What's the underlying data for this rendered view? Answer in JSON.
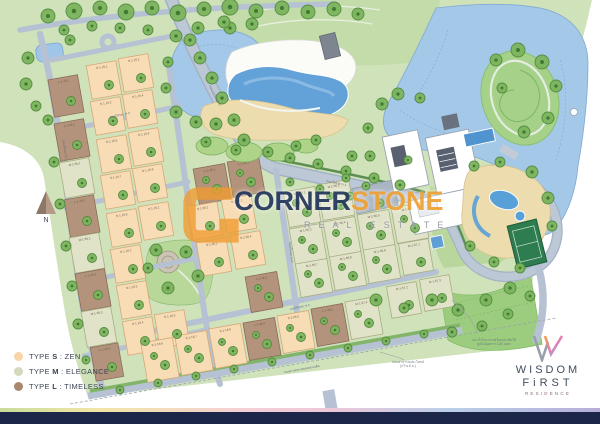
{
  "watermark": {
    "part1": "CORNER",
    "part2": "STONE",
    "tagline": "REAL ESTATE",
    "navy": "#24375c",
    "orange": "#f0a236"
  },
  "compass": {
    "label": "N"
  },
  "legend": {
    "items": [
      {
        "prefix": "TYPE",
        "letter": "S",
        "sep": ":",
        "name": "ZEN",
        "color": "#f9d4a8"
      },
      {
        "prefix": "TYPE",
        "letter": "M",
        "sep": ":",
        "name": "ELEGANCE",
        "color": "#d4d8bd"
      },
      {
        "prefix": "TYPE",
        "letter": "L",
        "sep": ":",
        "name": "TIMELESS",
        "color": "#a9886e"
      }
    ]
  },
  "brand": {
    "line1": "WISDOM",
    "line2": "FiRST",
    "line3": "RESIDENCE"
  },
  "map": {
    "colors": {
      "S": "#f8dcb6",
      "Sb": "#d4a876",
      "M": "#e1e3c9",
      "Mb": "#a9ad85",
      "L": "#b3937b",
      "Lb": "#8a6e58"
    },
    "plots": [
      [
        "L",
        66,
        96,
        30,
        38,
        -10,
        "L-1-45.1"
      ],
      [
        "L",
        72,
        140,
        30,
        38,
        -10,
        "L-1-45.2"
      ],
      [
        "M",
        77,
        178,
        30,
        36,
        -10,
        "M-1-55.1"
      ],
      [
        "L",
        82,
        216,
        30,
        38,
        -10,
        "L-1-45.3"
      ],
      [
        "M",
        87,
        253,
        30,
        36,
        -10,
        "M-1-55.2"
      ],
      [
        "L",
        93,
        290,
        30,
        38,
        -10,
        "L-1-45.4"
      ],
      [
        "M",
        99,
        327,
        30,
        36,
        -10,
        "M-1-55.3"
      ],
      [
        "L",
        107,
        362,
        28,
        34,
        -10,
        "L-1-45.5"
      ],
      [
        "S",
        104,
        80,
        30,
        34,
        -10,
        "S-1-15.1"
      ],
      [
        "S",
        136,
        73,
        30,
        34,
        -10,
        "S-1-15.2"
      ],
      [
        "S",
        108,
        116,
        30,
        34,
        -10,
        "S-1-15.3"
      ],
      [
        "S",
        140,
        109,
        30,
        34,
        -10,
        "S-1-15.4"
      ],
      [
        "S",
        114,
        154,
        30,
        34,
        -10,
        "S-1-15.5"
      ],
      [
        "S",
        146,
        147,
        30,
        34,
        -10,
        "S-1-15.6"
      ],
      [
        "S",
        118,
        190,
        30,
        34,
        -10,
        "S-1-15.7"
      ],
      [
        "S",
        150,
        183,
        30,
        34,
        -10,
        "S-1-15.8"
      ],
      [
        "S",
        124,
        228,
        30,
        34,
        -10,
        "S-1-15.9"
      ],
      [
        "S",
        156,
        221,
        30,
        34,
        -10,
        "S-1-16.1"
      ],
      [
        "S",
        128,
        264,
        30,
        34,
        -10,
        "S-1-16.2"
      ],
      [
        "S",
        134,
        300,
        30,
        34,
        -10,
        "S-1-16.3"
      ],
      [
        "S",
        140,
        336,
        30,
        34,
        -10,
        "S-1-16.4"
      ],
      [
        "S",
        172,
        329,
        30,
        34,
        -10,
        "S-1-16.5"
      ],
      [
        "L",
        212,
        184,
        32,
        36,
        -10,
        "L-1-46.1"
      ],
      [
        "L",
        246,
        177,
        32,
        36,
        -10,
        "L-1-46.2"
      ],
      [
        "S",
        205,
        221,
        30,
        34,
        -10,
        "S-1-55.1"
      ],
      [
        "S",
        239,
        214,
        30,
        34,
        -10,
        "S-1-55.2"
      ],
      [
        "S",
        214,
        257,
        30,
        34,
        -10,
        "S-1-55.3"
      ],
      [
        "S",
        248,
        250,
        30,
        34,
        -10,
        "S-1-55.4"
      ],
      [
        "M",
        302,
        207,
        32,
        36,
        -10,
        "M-1-56.1"
      ],
      [
        "M",
        336,
        200,
        32,
        36,
        -10,
        "M-1-56.2"
      ],
      [
        "M",
        308,
        244,
        32,
        36,
        -10,
        "M-1-56.3"
      ],
      [
        "M",
        342,
        237,
        32,
        36,
        -10,
        "M-1-56.4"
      ],
      [
        "M",
        376,
        230,
        32,
        36,
        -10,
        "M-1-56.5"
      ],
      [
        "M",
        410,
        223,
        32,
        36,
        -10,
        "M-1-56.6"
      ],
      [
        "M",
        314,
        278,
        32,
        34,
        -10,
        "M-1-56.7"
      ],
      [
        "M",
        348,
        271,
        32,
        34,
        -10,
        "M-1-56.8"
      ],
      [
        "M",
        382,
        264,
        32,
        34,
        -10,
        "M-1-56.9"
      ],
      [
        "M",
        416,
        257,
        30,
        32,
        -10,
        "M-1-57.1"
      ],
      [
        "L",
        264,
        292,
        32,
        36,
        -10,
        "L-1-46.3"
      ],
      [
        "M",
        404,
        300,
        30,
        32,
        -10,
        "M-1-57.2"
      ],
      [
        "M",
        437,
        293,
        30,
        32,
        -10,
        "M-1-57.3"
      ],
      [
        "S",
        160,
        360,
        32,
        40,
        -10,
        "S-1-16.6"
      ],
      [
        "S",
        194,
        353,
        32,
        40,
        -10,
        "S-1-16.7"
      ],
      [
        "S",
        228,
        346,
        32,
        40,
        -10,
        "S-1-16.8"
      ],
      [
        "L",
        262,
        339,
        32,
        38,
        -10,
        "L-1-46.4"
      ],
      [
        "S",
        296,
        332,
        32,
        38,
        -10,
        "S-1-55.5"
      ],
      [
        "L",
        330,
        325,
        32,
        38,
        -10,
        "L-1-46.5"
      ],
      [
        "M",
        364,
        318,
        32,
        38,
        -10,
        "M-1-57.4"
      ]
    ],
    "trees": [
      [
        48,
        16,
        7
      ],
      [
        74,
        11,
        8
      ],
      [
        100,
        8,
        7
      ],
      [
        126,
        12,
        8
      ],
      [
        152,
        8,
        7
      ],
      [
        178,
        13,
        8
      ],
      [
        204,
        9,
        7
      ],
      [
        230,
        7,
        8
      ],
      [
        256,
        11,
        7
      ],
      [
        282,
        8,
        7
      ],
      [
        308,
        12,
        7
      ],
      [
        334,
        9,
        7
      ],
      [
        358,
        14,
        6
      ],
      [
        64,
        30,
        5
      ],
      [
        92,
        26,
        5
      ],
      [
        120,
        28,
        5
      ],
      [
        148,
        30,
        5
      ],
      [
        230,
        28,
        6
      ],
      [
        252,
        24,
        6
      ],
      [
        190,
        40,
        6
      ],
      [
        200,
        58,
        6
      ],
      [
        212,
        78,
        6
      ],
      [
        222,
        98,
        6
      ],
      [
        234,
        120,
        6
      ],
      [
        244,
        140,
        6
      ],
      [
        176,
        36,
        6
      ],
      [
        198,
        28,
        6
      ],
      [
        224,
        22,
        6
      ],
      [
        168,
        62,
        5
      ],
      [
        166,
        88,
        5
      ],
      [
        176,
        112,
        6
      ],
      [
        196,
        122,
        6
      ],
      [
        216,
        124,
        6
      ],
      [
        48,
        120,
        5
      ],
      [
        54,
        162,
        5
      ],
      [
        60,
        204,
        5
      ],
      [
        66,
        246,
        5
      ],
      [
        72,
        286,
        5
      ],
      [
        78,
        324,
        5
      ],
      [
        86,
        360,
        4
      ],
      [
        28,
        58,
        6
      ],
      [
        26,
        84,
        6
      ],
      [
        36,
        106,
        5
      ],
      [
        70,
        40,
        5
      ],
      [
        206,
        142,
        5
      ],
      [
        236,
        150,
        5
      ],
      [
        268,
        152,
        5
      ],
      [
        296,
        146,
        5
      ],
      [
        316,
        140,
        5
      ],
      [
        290,
        158,
        5
      ],
      [
        318,
        164,
        5
      ],
      [
        346,
        171,
        5
      ],
      [
        374,
        178,
        5
      ],
      [
        400,
        185,
        5
      ],
      [
        290,
        182,
        4
      ],
      [
        320,
        189,
        4
      ],
      [
        350,
        196,
        4
      ],
      [
        380,
        203,
        4
      ],
      [
        382,
        104,
        6
      ],
      [
        398,
        94,
        6
      ],
      [
        420,
        98,
        5
      ],
      [
        368,
        128,
        5
      ],
      [
        370,
        156,
        5
      ],
      [
        366,
        186,
        4
      ],
      [
        496,
        60,
        6
      ],
      [
        518,
        50,
        7
      ],
      [
        542,
        62,
        7
      ],
      [
        556,
        86,
        6
      ],
      [
        548,
        118,
        6
      ],
      [
        502,
        88,
        5
      ],
      [
        524,
        132,
        6
      ],
      [
        474,
        166,
        5
      ],
      [
        500,
        162,
        5
      ],
      [
        532,
        172,
        6
      ],
      [
        548,
        198,
        6
      ],
      [
        552,
        226,
        5
      ],
      [
        470,
        246,
        5
      ],
      [
        494,
        262,
        5
      ],
      [
        520,
        268,
        5
      ],
      [
        376,
        300,
        6
      ],
      [
        404,
        308,
        5
      ],
      [
        432,
        300,
        6
      ],
      [
        458,
        310,
        6
      ],
      [
        486,
        300,
        6
      ],
      [
        510,
        288,
        6
      ],
      [
        452,
        332,
        5
      ],
      [
        482,
        326,
        5
      ],
      [
        508,
        314,
        5
      ],
      [
        530,
        296,
        5
      ],
      [
        120,
        390,
        4
      ],
      [
        158,
        383,
        4
      ],
      [
        196,
        376,
        4
      ],
      [
        234,
        369,
        4
      ],
      [
        272,
        362,
        4
      ],
      [
        310,
        355,
        4
      ],
      [
        348,
        348,
        4
      ],
      [
        386,
        341,
        4
      ],
      [
        424,
        334,
        4
      ],
      [
        156,
        250,
        6
      ],
      [
        186,
        252,
        6
      ],
      [
        198,
        276,
        6
      ],
      [
        168,
        288,
        6
      ],
      [
        148,
        268,
        5
      ],
      [
        352,
        156,
        5
      ],
      [
        346,
        178,
        4
      ],
      [
        408,
        160,
        4
      ]
    ],
    "street_labels": [
      {
        "text": "ถนนเมนโครงการ",
        "x": 214,
        "y": 96,
        "r": 63
      },
      {
        "text": "ถนนโครงการ 1",
        "x": 336,
        "y": 184,
        "r": 12
      },
      {
        "text": "ถนนโครงการ 2",
        "x": 64,
        "y": 150,
        "r": 82
      },
      {
        "text": "ถนนโครงการ 3",
        "x": 120,
        "y": 116,
        "r": -12
      },
      {
        "text": "ถนนโครงการ 4",
        "x": 290,
        "y": 252,
        "r": 84
      },
      {
        "text": "ถนนโครงการ 5",
        "x": 300,
        "y": 308,
        "r": -12
      },
      {
        "text": "ถนนทางหลวงชนบทสายเดิม",
        "x": 302,
        "y": 370,
        "r": -10
      }
    ],
    "annotations": [
      {
        "lines": [
          "แนวรั้วโครงการพร้อมแนวต้นไม้",
          "สูงไม่น้อยกว่า 1.80 เมตร"
        ],
        "x": 494,
        "y": 341,
        "leader": "452,300 470,318 478,334"
      },
      {
        "lines": [
          "ถนนสาธารณประโยชน์",
          "(กว้าง 6 ม.)"
        ],
        "x": 408,
        "y": 363,
        "leader": "380,352 400,358 404,360"
      }
    ]
  }
}
